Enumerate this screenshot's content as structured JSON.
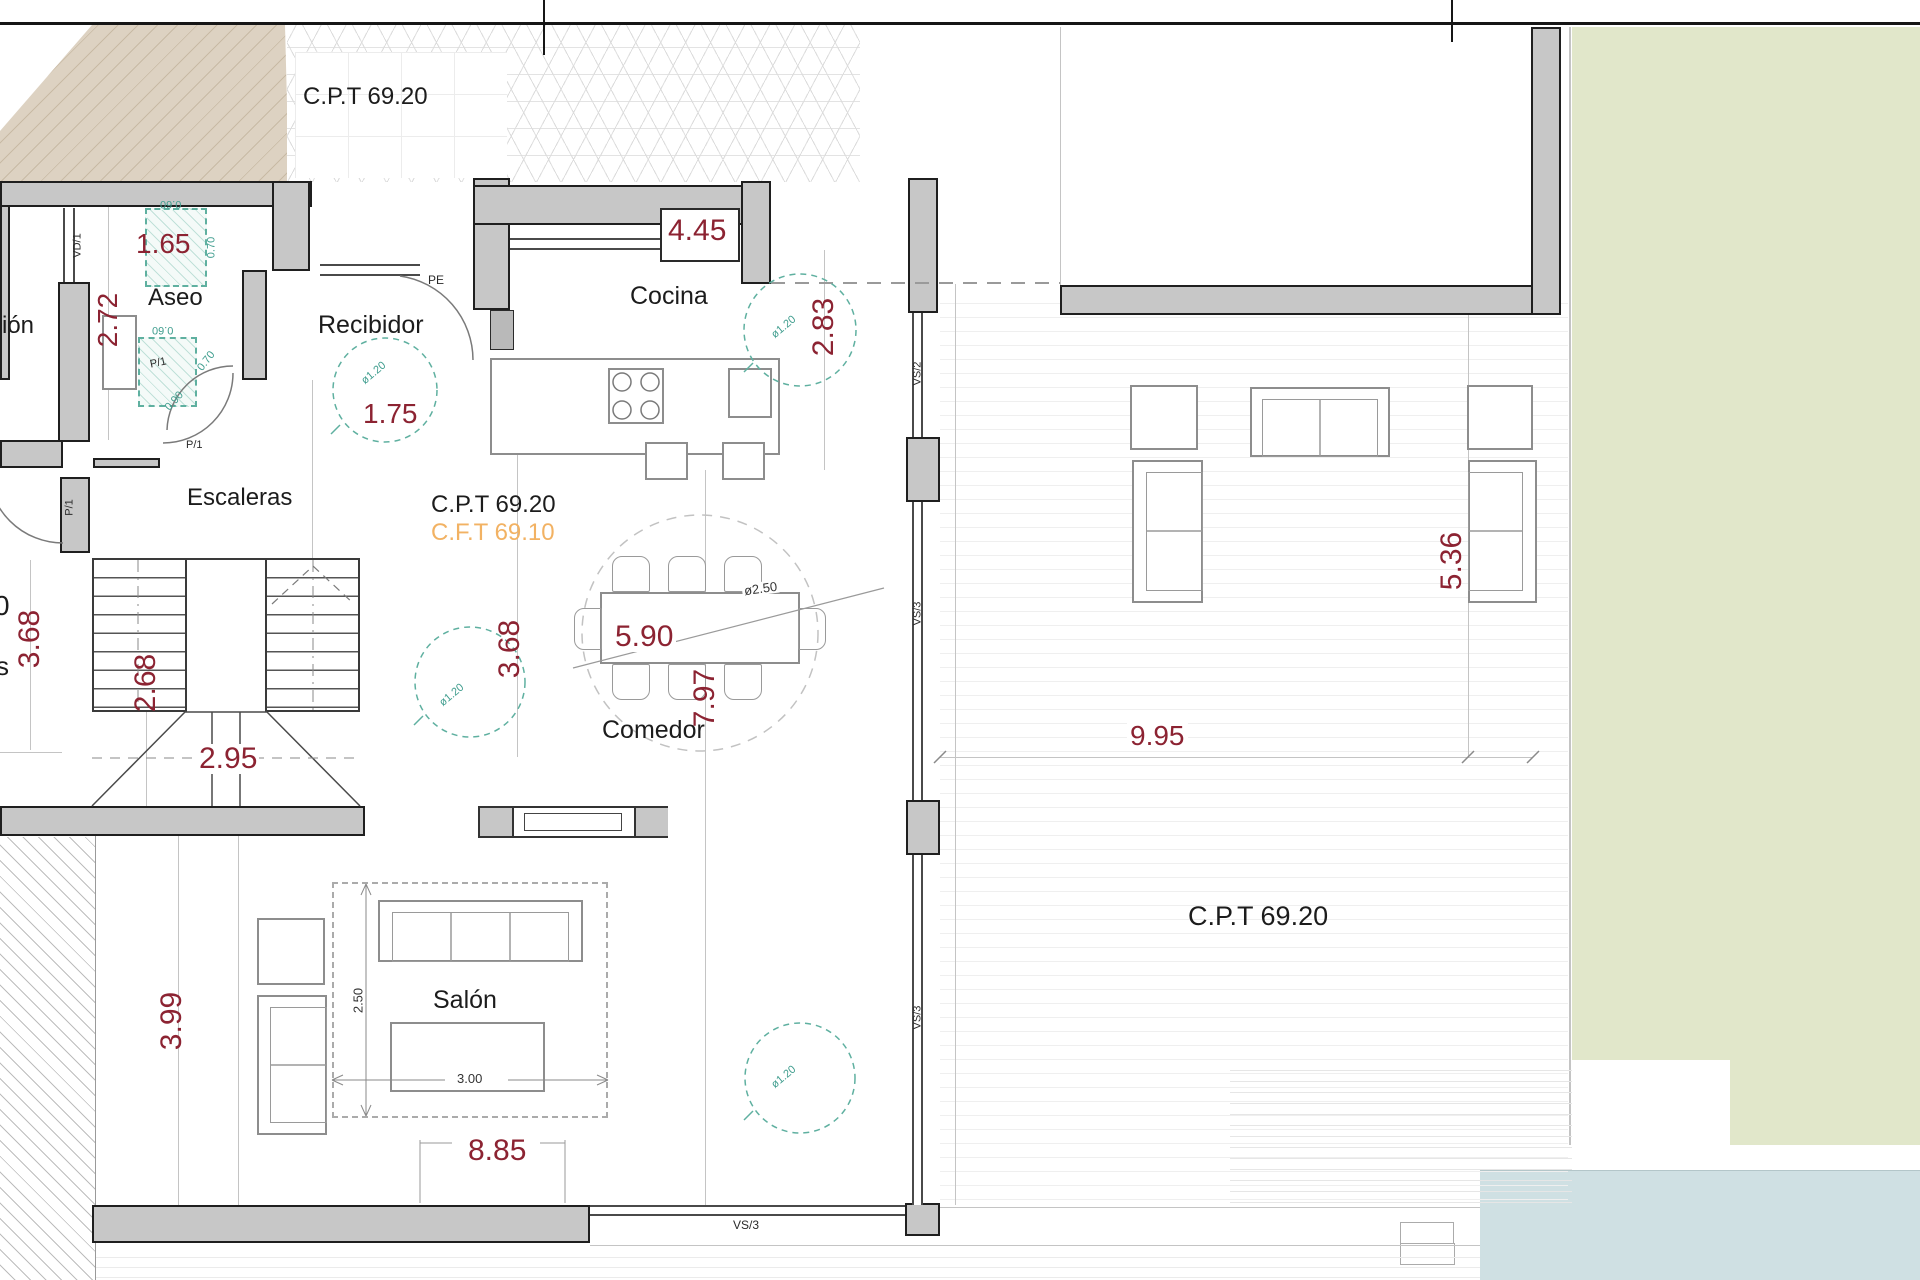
{
  "annotations": {
    "cpt_top_left": "C.P.T 69.20",
    "cpt_center": "C.P.T 69.20",
    "cft_center": "C.F.T 69.10",
    "cpt_terrace": "C.P.T 69.20"
  },
  "rooms": {
    "aseo": "Aseo",
    "recibidor": "Recibidor",
    "cocina": "Cocina",
    "escaleras": "Escaleras",
    "comedor": "Comedor",
    "salon": "Salón",
    "cut_room": "ión",
    "cut_zero": "0",
    "cut_s": "s"
  },
  "dims_red": {
    "aseo_w": "1.65",
    "aseo_h": "2.72",
    "recibidor_w": "1.75",
    "cocina_w": "4.45",
    "cocina_h": "2.83",
    "comedor_w": "5.90",
    "comedor_h": "3.68",
    "left_wing": "3.68",
    "stairs_w": "2.68",
    "stairs_l": "2.95",
    "salon_h": "7.97",
    "salon_side": "3.99",
    "salon_w": "8.85",
    "terrace_side": "5.36",
    "terrace_w": "9.95"
  },
  "dims_black": {
    "salon_zone_h": "2.50",
    "salon_zone_w": "3.00",
    "turn_circle": "ø2.50"
  },
  "dims_teal": {
    "fixture_w": "0.60",
    "fixture_d": "0.70",
    "door_w": "0.90",
    "circle_d": "ø1.20"
  },
  "openings": {
    "vd1": "VD/1",
    "pe": "PE",
    "p1": "P/1",
    "vs2": "VS/2",
    "vs3": "VS/3"
  },
  "colors": {
    "dim_red": "#8c2332",
    "cft_orange": "#f2b263",
    "teal": "#3f9d8e",
    "wall_gray": "#c7c7c7",
    "beige": "#ddd2c2",
    "green": "#e1e7ca",
    "pool": "#cfe0e3"
  }
}
